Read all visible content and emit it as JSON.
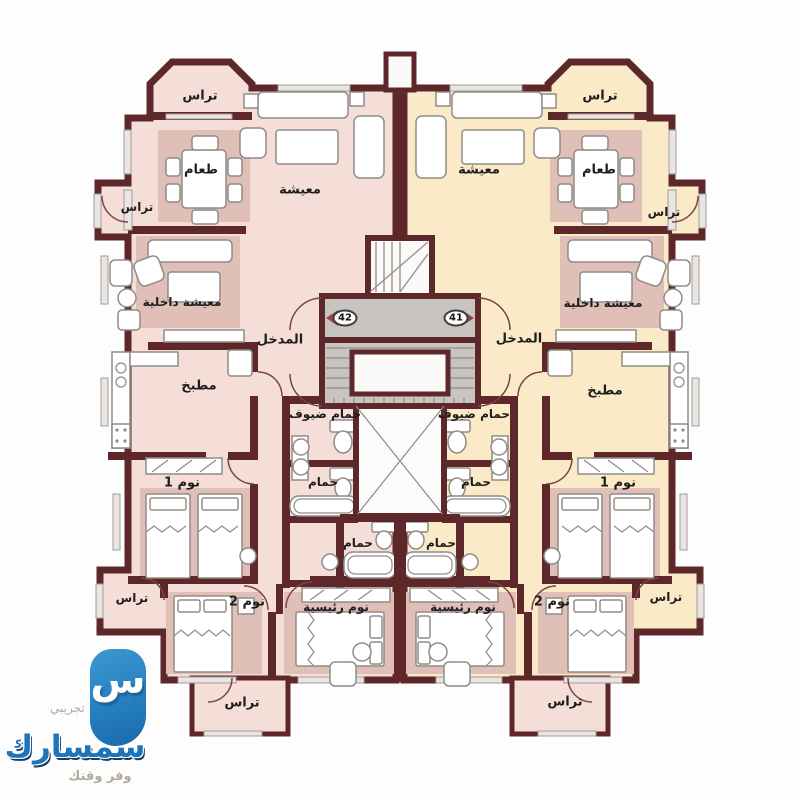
{
  "watermark": {
    "trial_label": "تجريبي",
    "brand_name": "سمسارك",
    "tagline": "وفر وقتك",
    "logo_letter": "س",
    "logo_blue": "#2a84c4",
    "wordmark_blue": "#1d74ba"
  },
  "plan": {
    "unit_left_number": "42",
    "unit_right_number": "41",
    "labels": {
      "terrace": "تراس",
      "dining": "طعام",
      "living": "معيشة",
      "inner_living": "معيشة داخلية",
      "entrance": "المدخل",
      "kitchen": "مطبخ",
      "guest_bath": "حمام ضيوف",
      "bath": "حمام",
      "bedroom1": "نوم 1",
      "bedroom2": "نوم 2",
      "master_bedroom": "نوم رئيسية"
    },
    "colors": {
      "wall": "#5e282b",
      "unit_left_fill": "#f4ded7",
      "unit_right_fill": "#faeac7",
      "mat_left": "#e0bfb6",
      "mat_right": "#f0d79e",
      "core_fill": "#c8c5c1"
    }
  }
}
